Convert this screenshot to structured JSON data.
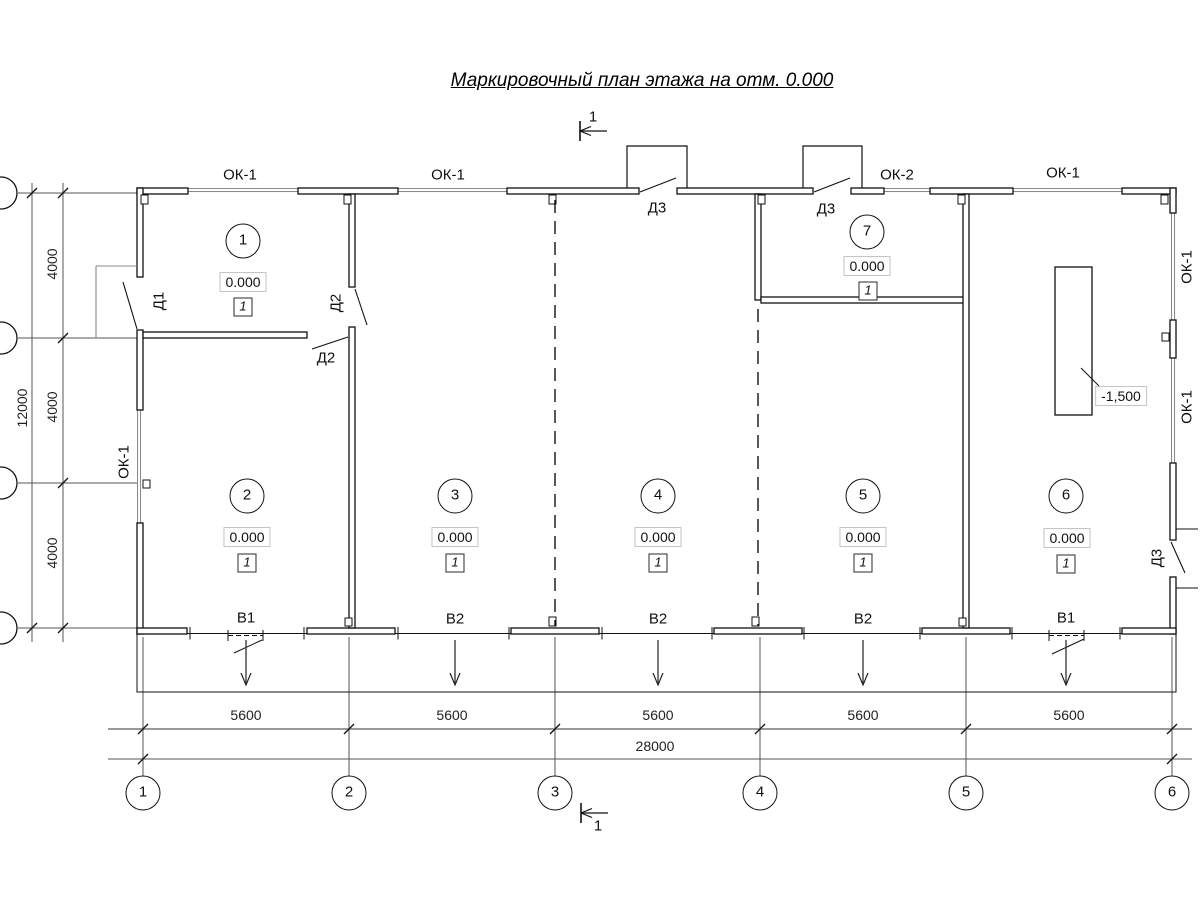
{
  "title": "Маркировочный план этажа на отм. 0.000",
  "section_mark": "1",
  "labels": {
    "ok1": "ОК-1",
    "ok2": "ОК-2",
    "d1": "Д1",
    "d2": "Д2",
    "d3": "Д3",
    "v1": "В1",
    "v2": "В2"
  },
  "rooms": [
    {
      "number": "1",
      "elevation": "0.000",
      "finish": "1"
    },
    {
      "number": "2",
      "elevation": "0.000",
      "finish": "1"
    },
    {
      "number": "3",
      "elevation": "0.000",
      "finish": "1"
    },
    {
      "number": "4",
      "elevation": "0.000",
      "finish": "1"
    },
    {
      "number": "5",
      "elevation": "0.000",
      "finish": "1"
    },
    {
      "number": "6",
      "elevation": "0.000",
      "finish": "1"
    },
    {
      "number": "7",
      "elevation": "0.000",
      "finish": "1"
    }
  ],
  "pit": {
    "elevation": "-1,500"
  },
  "dims": {
    "bay": "5600",
    "total_width": "28000",
    "row": "4000",
    "total_height": "12000"
  },
  "axes": [
    "1",
    "2",
    "3",
    "4",
    "5",
    "6"
  ],
  "colors": {
    "line": "#111111",
    "aux": "#888888",
    "dim_thick": "#999999"
  }
}
